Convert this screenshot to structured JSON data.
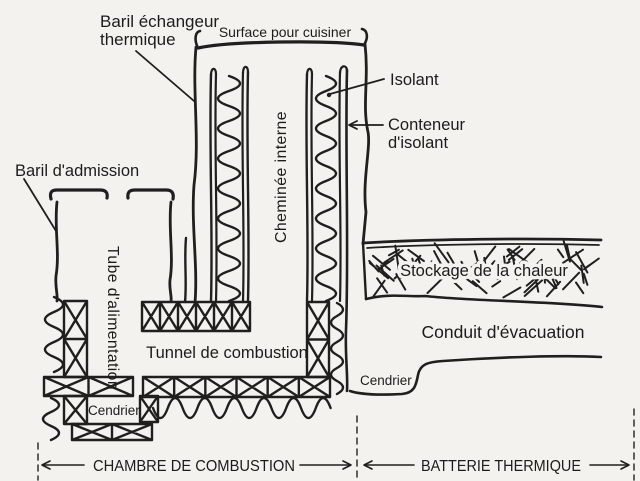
{
  "diagram": {
    "type": "hand-drawn technical schematic",
    "subject": "rocket mass heater cross-section (French labels)"
  },
  "labels": {
    "baril_echangeur_line1": "Baril échangeur",
    "baril_echangeur_line2": "thermique",
    "surface": "Surface pour cuisiner",
    "isolant": "Isolant",
    "conteneur_line1": "Conteneur",
    "conteneur_line2": "d'isolant",
    "baril_admission": "Baril d'admission",
    "tube_alimentation": "Tube d'alimentation",
    "cheminee_interne": "Cheminée interne",
    "stockage": "Stockage de la chaleur",
    "conduit": "Conduit d'évacuation",
    "tunnel": "Tunnel de combustion",
    "cendrier_gauche": "Cendrier",
    "cendrier_droit": "Cendrier",
    "section_chambre": "CHAMBRE DE COMBUSTION",
    "section_batterie": "BATTERIE THERMIQUE"
  },
  "colors": {
    "ink": "#201f1d",
    "paper": "#f3f2ee"
  }
}
